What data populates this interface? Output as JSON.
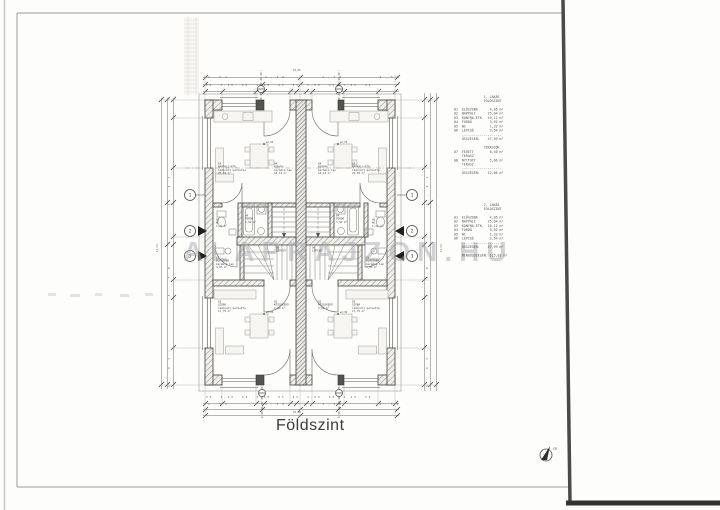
{
  "meta": {
    "title": "Földszint",
    "watermark": "ALAPRAJZON.HU",
    "north_label": "m"
  },
  "markers": {
    "s1": "1",
    "s2": "2",
    "s3": "3"
  },
  "schedule": {
    "unit1": "                1. LAKÁS\n                FÖLDSZINT\n\n 01  ELŐSZOBA      4,05 m²\n 02  NAPPALI      25,04 m²\n 03  KONYHA-ÉTK.  10,12 m²\n 04  FÜRDŐ         3,92 m²\n 05  WC            1,32 m²\n 06  LÉPCSŐ        3,54 m²\n     --------------------\n     ÖSSZESEN:    47,99 m²\n\n                TERASZOK\n 07  FEDETT        6,40 m²\n     TERASZ\n 08  NYITOTT       5,66 m²\n     TERASZ\n     --------------------\n     ÖSSZESEN:    12,06 m²",
    "unit2": "                2. LAKÁS\n                FÖLDSZINT\n\n 01  ELŐSZOBA      4,05 m²\n 02  NAPPALI      25,04 m²\n 03  KONYHA-ÉTK.  10,12 m²\n 04  FÜRDŐ         3,92 m²\n 05  WC            1,32 m²\n 06  LÉPCSŐ        3,54 m²\n     --------------------\n     ÖSSZESEN:    47,99 m²\n\n     MINDÖSSZESEN: 115,02 m²"
  },
  "rooms": {
    "nappali": "03\nNAPPALI+ÉTK.\nlaminált parketta\n25,04 m²",
    "konyha": "04\nKONYHA\nkerámia lap\n10,12 m²",
    "szoba": "02\nSZOBA\nlaminált parketta\n17,75 m²",
    "eloszoba": "01\nELŐSZOBA\nkerámia lap\n4,05 m²",
    "wc": "05\nWC\n1,32 m²",
    "furdo": "04\nFÜRDŐ\n3,92 m²",
    "lepcso": "06\nLÉPCSŐ",
    "kozlekedo": "02\nKÖZLEKEDŐ\n2,80 m²",
    "level": "±0,00"
  },
  "dims": {
    "top_total": "18,86",
    "top_mid": "4,52      4,38      4,38      4,52",
    "top_small": "90  3,40  60  2,60  95  95  2,60  60  3,40  90",
    "bottom_small": "90  3,40  60  2,60  95  95  2,60  60  3,40  90",
    "bottom_mid": "4,52      4,38      4,38      4,52",
    "bottom_total": "18,86",
    "left_seg": "3,93      3,30      3,93",
    "left_total": "11,54",
    "right_seg": "3,93      3,30      3,93",
    "right_total": "11,54"
  }
}
